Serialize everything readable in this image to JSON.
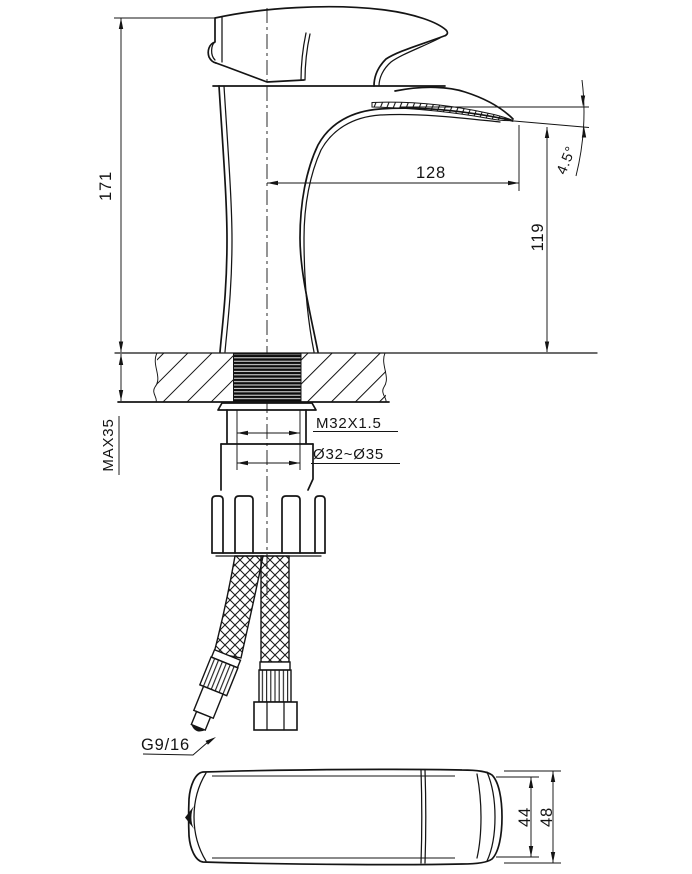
{
  "drawing": {
    "colors": {
      "background": "#ffffff",
      "line": "#141414"
    },
    "labels": {
      "overall_height": "171",
      "max_mounting_thickness": "MAX35",
      "spout_reach": "128",
      "outlet_height": "119",
      "outlet_angle": "4.5°",
      "shank_thread": "M32X1.5",
      "mounting_hole": "Ø32~Ø35",
      "hose_thread": "G9/16",
      "top_view_inner_width": "44",
      "top_view_outer_width": "48"
    }
  }
}
